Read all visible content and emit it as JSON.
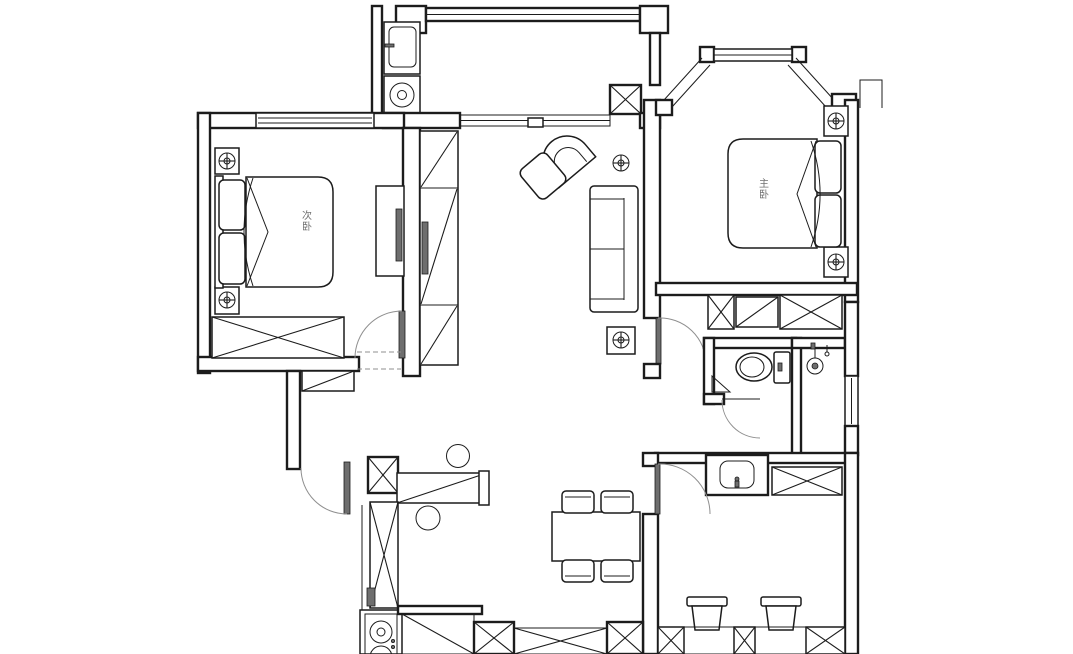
{
  "page": {
    "background": "#ffffff",
    "width": 1073,
    "height": 654
  },
  "plan": {
    "type": "apartment-floor-plan",
    "colors": {
      "background": "#ffffff",
      "line": "#1c1c1c",
      "door_arc": "#8f8f8f",
      "door_leaf": "#6e6e6e",
      "label": "#707070"
    },
    "rooms": {
      "secondary_bedroom": {
        "label": "次卧"
      },
      "master_bedroom": {
        "label": "主卧"
      }
    },
    "symbols": [
      "double-bed",
      "pillows",
      "nightstand",
      "ceiling-lamp",
      "wardrobe-hatch",
      "tv-panel",
      "dresser-desk",
      "bay-window-seat",
      "door-swing-arc",
      "sliding-balcony-door",
      "laundry-sink",
      "washing-machine",
      "structural-column",
      "armchair",
      "ottoman",
      "two-seat-sofa",
      "dining-table",
      "dining-chair",
      "bar-counter",
      "bar-stool",
      "kitchen-tall-cabinet",
      "gas-stove",
      "shoe-cabinet",
      "toilet",
      "shower-head",
      "washbasin",
      "closet-cabinet",
      "desk-chair",
      "window",
      "bay-window"
    ]
  }
}
